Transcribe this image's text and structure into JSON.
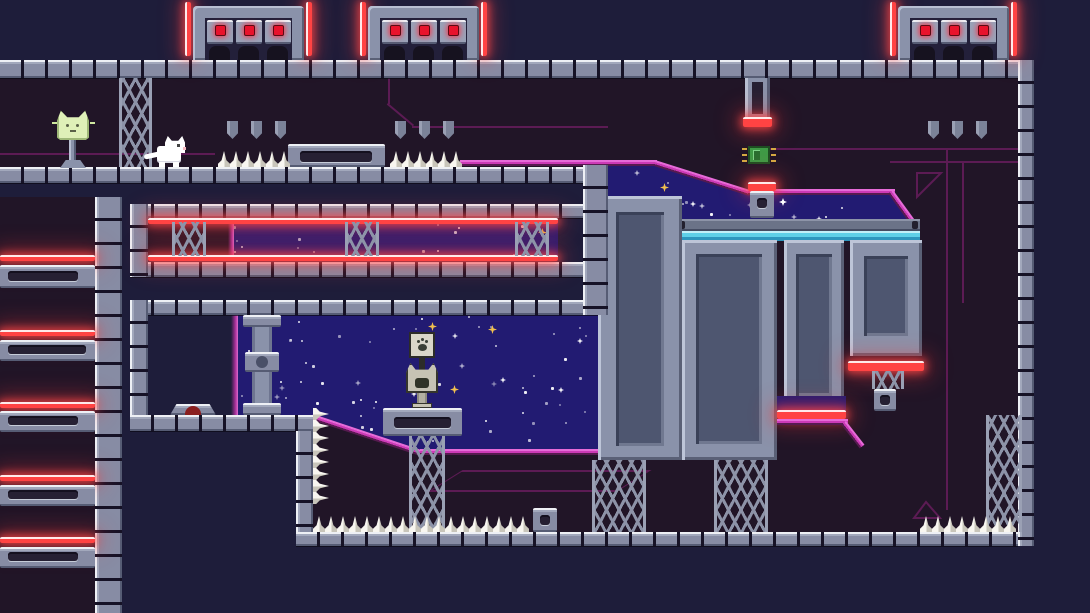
{
  "meta": {
    "domain": "Game",
    "scene": "pixel-art space-station platformer level",
    "viewport": {
      "width": 1090,
      "height": 613
    }
  },
  "palette": {
    "outside_bg": "#1e1d3a",
    "interior_bg": "#211527",
    "starfield": "#221b72",
    "tile_face": "#878ca4",
    "tile_hi": "#eef0f5",
    "tile_gap": "#161226",
    "panel_face": "#8a92aa",
    "panel_inset": "#4e5670",
    "laser_red": "#ff4343",
    "door_light": "#e8132c",
    "magenta": "#cb3ab6",
    "magenta_dark": "#5c1b54",
    "cyan": "#5fd0e8",
    "spike": "#efede4",
    "star_gold": "#f2c14e",
    "checkpoint_green": "#dff0b8",
    "chip_green": "#3f9a46"
  },
  "entities": {
    "player": {
      "label": "white cat player"
    },
    "checkpoint": {
      "label": "glowing cat-head checkpoint beacon"
    },
    "chip": {
      "label": "green circuit chip collectible"
    },
    "paw_sign": {
      "label": "paw print sign post"
    },
    "cat_statue": {
      "label": "cat head statue"
    },
    "conveyor": {
      "label": "cyan conveyor platform"
    },
    "ramp_device": {
      "label": "low ramp device with red light"
    },
    "pipe": {
      "label": "ceiling pipe with red laser cap"
    }
  },
  "doors": {
    "count": 3,
    "lights_per_door": 3,
    "light_color": "#e8132c"
  },
  "hazards": {
    "spike_rows": [
      {
        "id": "ledge-left",
        "count": 6,
        "dir": "up"
      },
      {
        "id": "ledge-right",
        "count": 6,
        "dir": "up"
      },
      {
        "id": "floor-left",
        "count": 18,
        "dir": "up"
      },
      {
        "id": "floor-right",
        "count": 8,
        "dir": "up"
      },
      {
        "id": "wall-column",
        "count": 8,
        "dir": "right"
      }
    ],
    "left_laser_ledges": 5,
    "red_laser_bars": 10
  },
  "decor": {
    "star_seed": 20240601,
    "gold_sparkles": 5
  }
}
